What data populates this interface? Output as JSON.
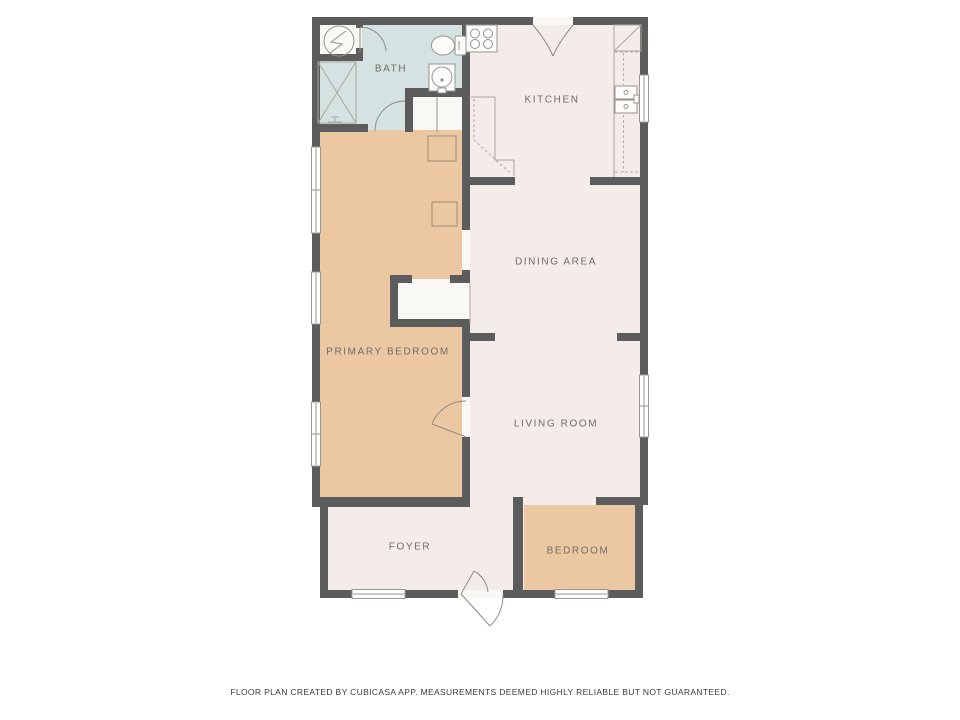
{
  "title": "Floor plan",
  "rooms": {
    "bath": {
      "label": "BATH"
    },
    "kitchen": {
      "label": "KITCHEN"
    },
    "dining": {
      "label": "DINING AREA"
    },
    "primary_bedroom": {
      "label": "PRIMARY BEDROOM"
    },
    "living": {
      "label": "LIVING ROOM"
    },
    "foyer": {
      "label": "FOYER"
    },
    "bedroom": {
      "label": "BEDROOM"
    }
  },
  "footer": {
    "disclaimer": "FLOOR PLAN CREATED BY CUBICASA APP. MEASUREMENTS DEEMED HIGHLY RELIABLE BUT NOT GUARANTEED."
  },
  "colors": {
    "wall": "#5d5c5c",
    "floor-cream": "#f4ece8",
    "floor-tan": "#ebc8a2",
    "floor-blue": "#d4e3e1",
    "fixture-fill": "#faf8f5",
    "fixture-stroke": "#97938d",
    "label": "#716c66"
  },
  "icons": [
    "electrical-panel-icon",
    "closet-x-icon",
    "toilet-icon",
    "washbasin-icon",
    "stove-burners-icon",
    "kitchen-sink-icon",
    "refrigerator-icon",
    "stairs-icon",
    "door-swing-icon",
    "window-icon"
  ]
}
